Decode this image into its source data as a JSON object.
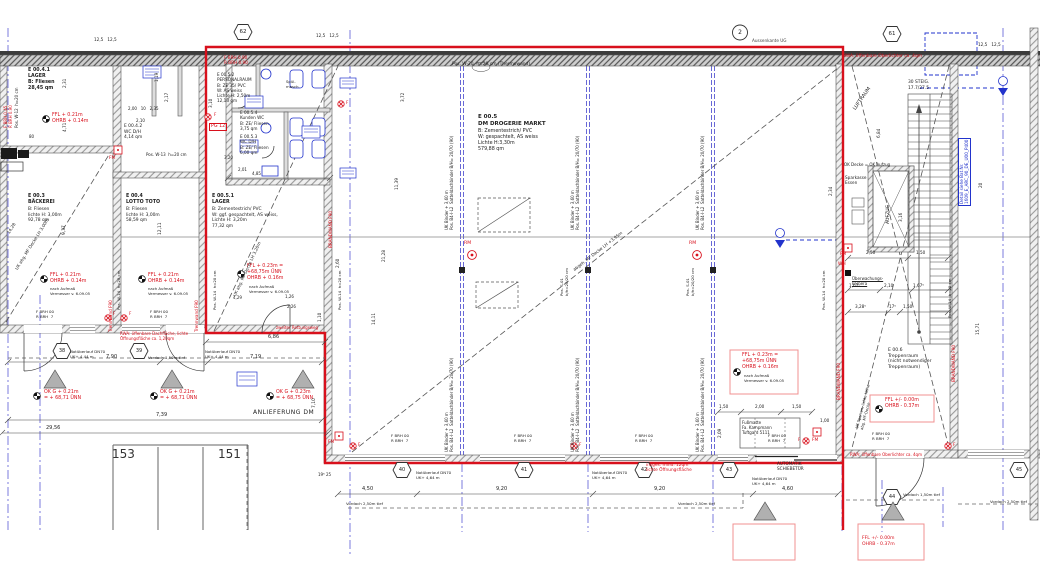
{
  "plan_title": "Erdgeschoss Werkplan DM Drogerie Markt",
  "rooms": {
    "e0041": "E 00.4.1\nLAGER\nB: Fliesen\n28,45 qm",
    "e0042": "E 00.4.2\nWC D/H\n4,14 qm",
    "e003_title": "E 00.3\nBÄCKEREI",
    "e003_body": "B: Fliesen\nlichte H: 3,00m\n92,78 qm",
    "e004_title": "E 00.4\nLOTTO TOTO",
    "e004_body": "B: Fliesen\nlichte H: 3,00m\n58,59 qm",
    "e0052": "E 00.5.2\nPERSONALRAUM\nB: ZE 35/ PVC\nW: AS weiss\nLichte H: 2,50m\n12,13 qm",
    "e0054": "E 00.5.4\nKunden WC\nB: ZE/ Fliesen\n3,75 qm",
    "e0053": "E 00.5.3\nWC D/H\nB: ZE/ Fliesen\n6,00 qm",
    "e0051_title": "E 00.5.1\nLAGER",
    "e0051_body": "B: Zementestrich/ PVC\nW: ggf. gespachtelt, AS weiss,\nLichte H: 3,20m\n77,32 qm",
    "e005_title": "E 00.5\nDM DROGERIE MARKT",
    "e005_body": "B: Zementestrich/ PVC\nW: gespachtelt, AS weiss\nLichte H:3,30m\n579,88 qm",
    "e006": "E 00.6\nTreppenraum\n(nicht notwendiger\nTreppenraum)"
  },
  "labels": {
    "fbrh007": "F BRH 00\nR BRH  7",
    "fbrh09": "F BRH 0.90\nR BRH 0.90",
    "fbrh045": "F BRH 0.45\nR BRH 0.90",
    "brandwand": "BRANDWAND F90",
    "trennwand": "Trennwand F90",
    "binder": "UK Binder + 3,60 m\nPos. B4-I-L2  Satteldachbinder B/H= 20/70 (90)",
    "pos_s01": "Pos. S-01\nb/h=20/20 cm",
    "pos_w14": "Pos. W-14  h=20 cm",
    "pos_w13": "Pos. W-13  h=20 cm",
    "pos_w12": "Pos. W-12  h=20 cm",
    "pos_w20": "Pos. W-20  h=20 cm (Thermowand)",
    "not464": "Notüberlauf DN70\nUK+ 4,64 m",
    "not444": "Notüberlauf DN70\nUK+ 4,44 m",
    "vord250": "Vordach 2,50m tief",
    "vord150": "Vordach 1,50m tief",
    "fm": "FM",
    "wh": "WH",
    "rm": "RM",
    "f": "F",
    "pg12": "PG 12",
    "nach": "nach Aufmaß\nVermesser v. 6.09.05",
    "ffl021": "FFL + 0.21m\nOHRB + 0.14m",
    "ffl023": "FFL + 0.23m =\n+68,75m ÜNN\nOHRB + 0.16m",
    "ffl000": "FFL +/- 0.00m\nOHRB - 0.37m",
    "okg021": "OK G + 0.21m\n= + 68,71 ÜNN",
    "okg023": "OK G + 0.23m\n= + 68,75 ÜNN"
  },
  "red_notes": {
    "rwa_top": "RWA: öffenbare Oberlichter ca. 4qm",
    "rwa_dach": "RWA: öffenbare Dachfläche, lichte\nÖffnungsfläche ca. 1,20qm",
    "rwa_trepp": "RWA: öffenbare Oberlichter ca. 4qm",
    "insges": "insges. mind. 12qm\nlichte Öffnungsfläche",
    "zweiter": "zweiter Rettungsweg"
  },
  "ann": {
    "anlieferung": "ANLIEFERUNG DM",
    "automatik": "AUTOMATIK\nSCHIEBETÜR",
    "fussmatte": "Fußmatte\nFa. Kampmann\nTuftgard 5111",
    "aufzug": "AUFZUG",
    "steig": "30 STEIG.\n17.7/27.5",
    "luftraum": "LUFTRAUM",
    "ok_decke": "OK Decke = OK Aufzug",
    "sparkasse": "Sparkasse\nEssen",
    "kamera": "Überwachungs-\nkamera",
    "detail": "Detail siehe Bat.Nr.\n1609_E_ARC_90_DE_U00_P400",
    "aussenkante": "Aussenkante UG",
    "abgeh": "abgeh. MF Decke LH +3,95m",
    "uk300": "UK abg. MF Decke LH 3,00m",
    "uk320": "UK abg. MF Decke LH 3,20m",
    "uk_sparren": "UK Sparren, lichte Höhe\nabg. MF-Decke",
    "spuel": "Spül-\nmasch."
  },
  "mk": {
    "m62": "62",
    "m2": "2",
    "m61": "61",
    "m38": "38",
    "m39": "39",
    "m40": "40",
    "m41": "41",
    "m42": "42",
    "m43": "43",
    "m44": "44",
    "m45": "45",
    "p153": "153",
    "p151": "151"
  },
  "dims": {
    "d450": "4,50",
    "d920": "9,20",
    "d460": "4,60",
    "d790": "7,90",
    "d719": "7,19",
    "d739": "7,39",
    "d2956": "29,56",
    "d686": "6,86",
    "d710": "7,10",
    "d937": "9,37",
    "d1211": "12,11",
    "d1428": "14,28",
    "d471": "4,71",
    "d231": "2,31",
    "d310": "3,10",
    "d119": "1,19",
    "d217": "2,17",
    "d320": "3,20",
    "d201": "2,01",
    "d485": "4,85",
    "d372": "3,72",
    "d1139": "11,39",
    "d260": "2,60",
    "d1411": "14,11",
    "d2128": "21,28",
    "d110": "1,10",
    "d126": "1,26",
    "d226": "2,26",
    "d429": "4,29",
    "d250": "2,50",
    "d150": "1,50",
    "d162": "1,62⁵",
    "d210": "2,10",
    "d167": "1,67⁵",
    "d328": "3,28⁵",
    "d17": "17⁵",
    "d100": "1,00",
    "d200": "2,00",
    "d209": "2,09",
    "d684": "6,84",
    "d234": "2,34",
    "d20": "20",
    "d1571": "15,71",
    "d316": "3,16",
    "d195": "19⁵ 25",
    "d80": "80",
    "d125": "12,5   12,5",
    "dwc": "2,00   10   2,35"
  },
  "colors": {
    "red": "#d8101c",
    "blue": "#2233cc",
    "grid_blue": "#5b5bd6",
    "wall": "#3c3c3c"
  }
}
